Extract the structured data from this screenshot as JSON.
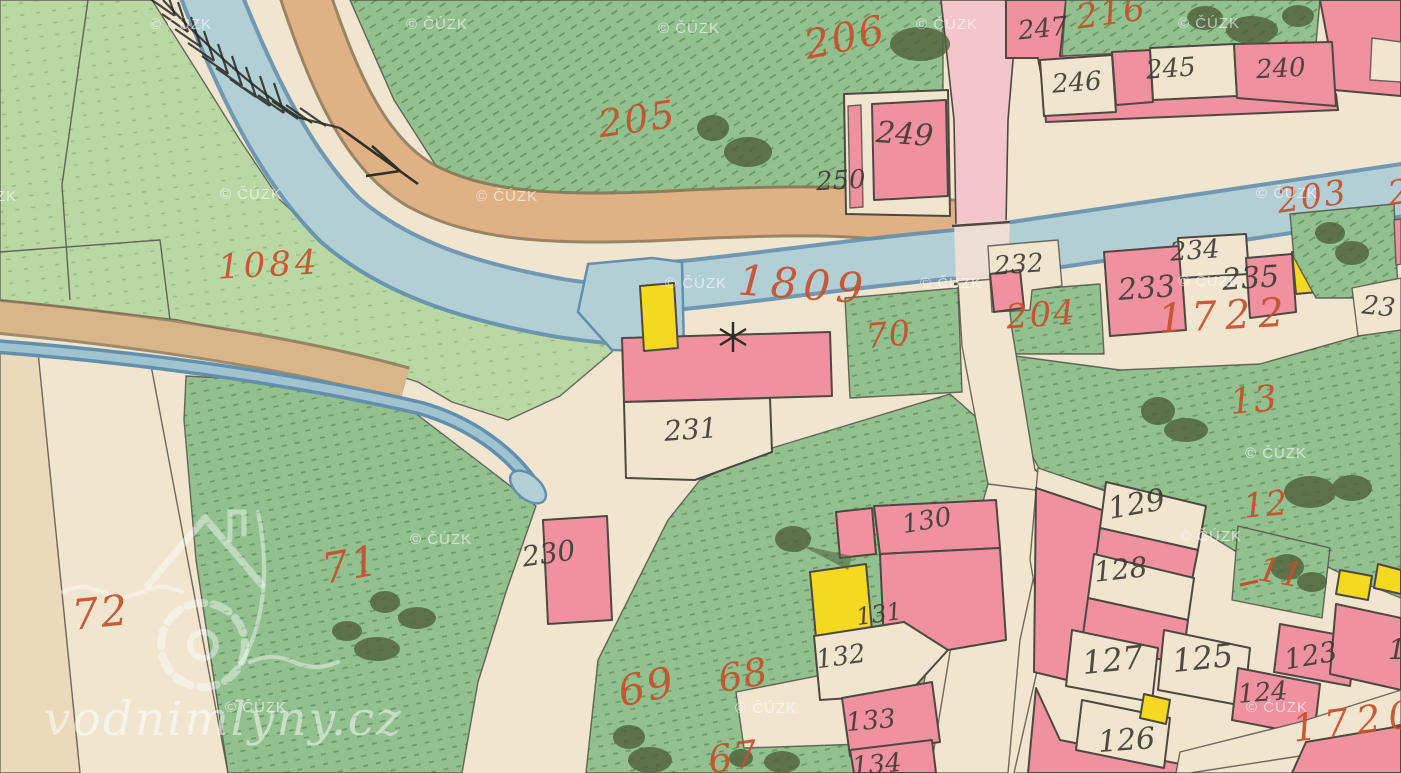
{
  "map": {
    "source_watermark": "© ČÚZK",
    "brand_watermark": "vodnimlyny.cz",
    "colors": {
      "parchment": "#f0e6cf",
      "field_pale": "#ead9ba",
      "field_light": "#b9d8a3",
      "meadow_green": "#92c18f",
      "tree_green": "#50613c",
      "water": "#b2cfd6",
      "water_edge": "#628fae",
      "road_tan": "#dfb184",
      "road_tan_edge": "#8a7352",
      "road_pink": "#f2c6ca",
      "building_pink": "#f0919f",
      "building_wood_yellow": "#f5d91f",
      "ink": "#4e4840",
      "parcel_number_red": "#c7502c",
      "house_number_black": "#3e3a31"
    },
    "symbols": {
      "flow_arrow": "arrow pointing downstream (south-east)",
      "weir_marks": "feather hatching on upper stream",
      "water_mill": "asterisk mill-wheel symbol near parcel 1809"
    },
    "parcel_labels": [
      {
        "text": "1084",
        "x": 218,
        "y": 248,
        "size": 34,
        "rot": -3,
        "ls": 4
      },
      {
        "text": "205",
        "x": 598,
        "y": 100,
        "size": 38,
        "rot": -8,
        "ls": 2
      },
      {
        "text": "206",
        "x": 804,
        "y": 18,
        "size": 40,
        "rot": -12,
        "ls": 2
      },
      {
        "text": "216",
        "x": 1076,
        "y": -4,
        "size": 34,
        "rot": -8,
        "ls": 2
      },
      {
        "text": "203",
        "x": 1277,
        "y": 180,
        "size": 34,
        "rot": -8,
        "ls": 2
      },
      {
        "text": "2",
        "x": 1388,
        "y": 176,
        "size": 34,
        "rot": -8,
        "ls": 0
      },
      {
        "text": "1809",
        "x": 738,
        "y": 264,
        "size": 42,
        "rot": 4,
        "ls": 6
      },
      {
        "text": "70",
        "x": 866,
        "y": 318,
        "size": 34,
        "rot": -6,
        "ls": 1
      },
      {
        "text": "204",
        "x": 1006,
        "y": 298,
        "size": 34,
        "rot": -4,
        "ls": 2
      },
      {
        "text": "1722",
        "x": 1158,
        "y": 296,
        "size": 40,
        "rot": -3,
        "ls": 8
      },
      {
        "text": "13",
        "x": 1230,
        "y": 383,
        "size": 36,
        "rot": -5,
        "ls": 1
      },
      {
        "text": "12",
        "x": 1243,
        "y": 488,
        "size": 34,
        "rot": -5,
        "ls": 1
      },
      {
        "text": "11",
        "x": 1258,
        "y": 556,
        "size": 34,
        "rot": 10,
        "ls": 1
      },
      {
        "text": "1720",
        "x": 1292,
        "y": 702,
        "size": 38,
        "rot": -7,
        "ls": 8
      },
      {
        "text": "72",
        "x": 72,
        "y": 592,
        "size": 42,
        "rot": -6,
        "ls": 2
      },
      {
        "text": "71",
        "x": 322,
        "y": 544,
        "size": 42,
        "rot": -10,
        "ls": 2
      },
      {
        "text": "69",
        "x": 618,
        "y": 666,
        "size": 42,
        "rot": -12,
        "ls": 2
      },
      {
        "text": "68",
        "x": 718,
        "y": 656,
        "size": 38,
        "rot": -10,
        "ls": 1
      },
      {
        "text": "67",
        "x": 708,
        "y": 738,
        "size": 38,
        "rot": -8,
        "ls": 1
      }
    ],
    "house_labels": [
      {
        "text": "247",
        "x": 1018,
        "y": 16,
        "size": 26,
        "rot": -6
      },
      {
        "text": "246",
        "x": 1052,
        "y": 70,
        "size": 26,
        "rot": -4
      },
      {
        "text": "245",
        "x": 1146,
        "y": 56,
        "size": 26,
        "rot": -4
      },
      {
        "text": "240",
        "x": 1256,
        "y": 56,
        "size": 26,
        "rot": -3
      },
      {
        "text": "249",
        "x": 876,
        "y": 120,
        "size": 30,
        "rot": 4
      },
      {
        "text": "250",
        "x": 816,
        "y": 168,
        "size": 26,
        "rot": -3
      },
      {
        "text": "232",
        "x": 994,
        "y": 252,
        "size": 26,
        "rot": -4
      },
      {
        "text": "233",
        "x": 1118,
        "y": 274,
        "size": 30,
        "rot": -4
      },
      {
        "text": "234",
        "x": 1170,
        "y": 238,
        "size": 26,
        "rot": -4
      },
      {
        "text": "235",
        "x": 1222,
        "y": 264,
        "size": 30,
        "rot": -4
      },
      {
        "text": "23",
        "x": 1362,
        "y": 294,
        "size": 26,
        "rot": 6
      },
      {
        "text": "231",
        "x": 664,
        "y": 416,
        "size": 28,
        "rot": -4
      },
      {
        "text": "230",
        "x": 522,
        "y": 540,
        "size": 28,
        "rot": -8
      },
      {
        "text": "130",
        "x": 902,
        "y": 508,
        "size": 26,
        "rot": -10
      },
      {
        "text": "131",
        "x": 856,
        "y": 602,
        "size": 24,
        "rot": -8
      },
      {
        "text": "132",
        "x": 816,
        "y": 644,
        "size": 26,
        "rot": -8
      },
      {
        "text": "133",
        "x": 846,
        "y": 708,
        "size": 26,
        "rot": -5
      },
      {
        "text": "134",
        "x": 852,
        "y": 752,
        "size": 26,
        "rot": -5
      },
      {
        "text": "129",
        "x": 1108,
        "y": 490,
        "size": 30,
        "rot": -10
      },
      {
        "text": "128",
        "x": 1094,
        "y": 556,
        "size": 28,
        "rot": -6
      },
      {
        "text": "127",
        "x": 1082,
        "y": 644,
        "size": 32,
        "rot": -6
      },
      {
        "text": "125",
        "x": 1172,
        "y": 642,
        "size": 32,
        "rot": -6
      },
      {
        "text": "124",
        "x": 1238,
        "y": 680,
        "size": 26,
        "rot": -4
      },
      {
        "text": "123",
        "x": 1284,
        "y": 642,
        "size": 28,
        "rot": -10
      },
      {
        "text": "126",
        "x": 1098,
        "y": 726,
        "size": 30,
        "rot": -4
      },
      {
        "text": "1",
        "x": 1388,
        "y": 636,
        "size": 28,
        "rot": 0
      }
    ],
    "watermarks": [
      {
        "x": -45,
        "y": 188
      },
      {
        "x": 150,
        "y": 16
      },
      {
        "x": 406,
        "y": 16
      },
      {
        "x": 220,
        "y": 186
      },
      {
        "x": 476,
        "y": 188
      },
      {
        "x": 658,
        "y": 20
      },
      {
        "x": 916,
        "y": 16
      },
      {
        "x": 1178,
        "y": 15
      },
      {
        "x": 665,
        "y": 275
      },
      {
        "x": 920,
        "y": 275
      },
      {
        "x": 1178,
        "y": 273
      },
      {
        "x": 1256,
        "y": 185
      },
      {
        "x": 1245,
        "y": 445
      },
      {
        "x": 410,
        "y": 531
      },
      {
        "x": 1180,
        "y": 528
      },
      {
        "x": 225,
        "y": 699
      },
      {
        "x": 735,
        "y": 700
      },
      {
        "x": 1246,
        "y": 699
      }
    ]
  }
}
